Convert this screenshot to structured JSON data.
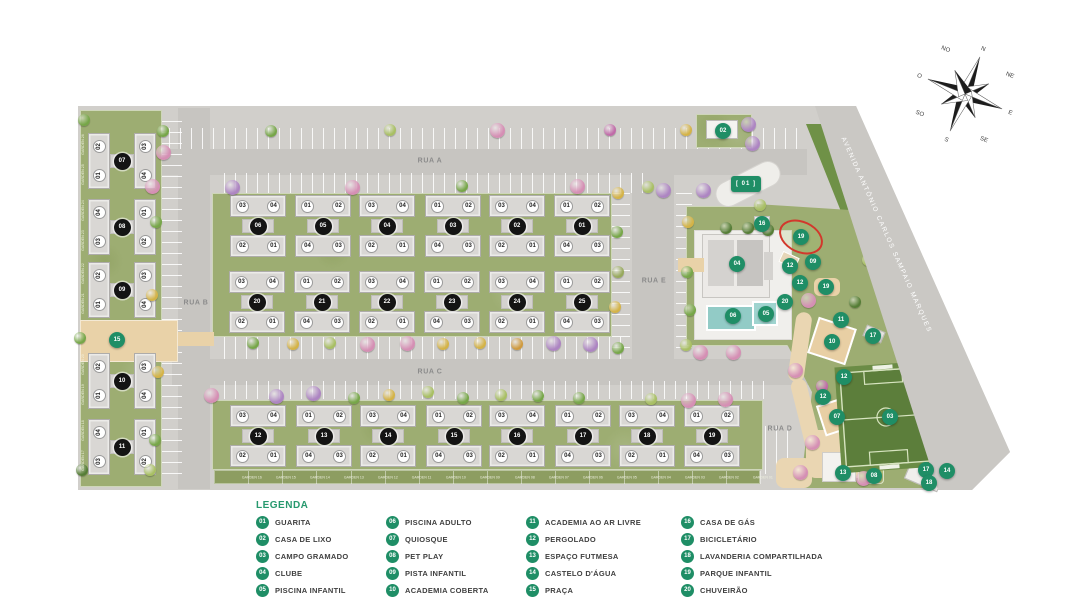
{
  "plan": {
    "avenue_label": "AVENIDA ANTÔNIO CARLOS SAMPAIO MARQUES",
    "streets": [
      {
        "label": "RUA A",
        "x": 430,
        "y": 161
      },
      {
        "label": "RUA B",
        "x": 196,
        "y": 303
      },
      {
        "label": "RUA C",
        "x": 430,
        "y": 372
      },
      {
        "label": "RUA D",
        "x": 780,
        "y": 429
      },
      {
        "label": "RUA E",
        "x": 654,
        "y": 281
      }
    ],
    "rows": [
      {
        "y": 226,
        "blocks": [
          {
            "id": "06",
            "x": 258,
            "top": [
              "03",
              "04"
            ],
            "bottom": [
              "02",
              "01"
            ]
          },
          {
            "id": "05",
            "x": 323,
            "top": [
              "01",
              "02"
            ],
            "bottom": [
              "04",
              "03"
            ]
          },
          {
            "id": "04",
            "x": 387,
            "top": [
              "03",
              "04"
            ],
            "bottom": [
              "02",
              "01"
            ]
          },
          {
            "id": "03",
            "x": 453,
            "top": [
              "01",
              "02"
            ],
            "bottom": [
              "04",
              "03"
            ]
          },
          {
            "id": "02",
            "x": 517,
            "top": [
              "03",
              "04"
            ],
            "bottom": [
              "02",
              "01"
            ]
          },
          {
            "id": "01",
            "x": 582,
            "top": [
              "01",
              "02"
            ],
            "bottom": [
              "04",
              "03"
            ]
          }
        ]
      },
      {
        "y": 302,
        "blocks": [
          {
            "id": "20",
            "x": 257,
            "top": [
              "03",
              "04"
            ],
            "bottom": [
              "02",
              "01"
            ]
          },
          {
            "id": "21",
            "x": 322,
            "top": [
              "01",
              "02"
            ],
            "bottom": [
              "04",
              "03"
            ]
          },
          {
            "id": "22",
            "x": 387,
            "top": [
              "03",
              "04"
            ],
            "bottom": [
              "02",
              "01"
            ]
          },
          {
            "id": "23",
            "x": 452,
            "top": [
              "01",
              "02"
            ],
            "bottom": [
              "04",
              "03"
            ]
          },
          {
            "id": "24",
            "x": 517,
            "top": [
              "03",
              "04"
            ],
            "bottom": [
              "02",
              "01"
            ]
          },
          {
            "id": "25",
            "x": 582,
            "top": [
              "01",
              "02"
            ],
            "bottom": [
              "04",
              "03"
            ]
          }
        ]
      },
      {
        "y": 436,
        "blocks": [
          {
            "id": "12",
            "x": 258,
            "top": [
              "03",
              "04"
            ],
            "bottom": [
              "02",
              "01"
            ]
          },
          {
            "id": "13",
            "x": 324,
            "top": [
              "01",
              "02"
            ],
            "bottom": [
              "04",
              "03"
            ]
          },
          {
            "id": "14",
            "x": 388,
            "top": [
              "03",
              "04"
            ],
            "bottom": [
              "02",
              "01"
            ]
          },
          {
            "id": "15",
            "x": 454,
            "top": [
              "01",
              "02"
            ],
            "bottom": [
              "04",
              "03"
            ]
          },
          {
            "id": "16",
            "x": 517,
            "top": [
              "03",
              "04"
            ],
            "bottom": [
              "02",
              "01"
            ]
          },
          {
            "id": "17",
            "x": 583,
            "top": [
              "01",
              "02"
            ],
            "bottom": [
              "04",
              "03"
            ]
          },
          {
            "id": "18",
            "x": 647,
            "top": [
              "03",
              "04"
            ],
            "bottom": [
              "02",
              "01"
            ]
          },
          {
            "id": "19",
            "x": 712,
            "top": [
              "01",
              "02"
            ],
            "bottom": [
              "04",
              "03"
            ]
          }
        ]
      }
    ],
    "column": {
      "x": 122,
      "blocks": [
        {
          "id": "07",
          "y": 161,
          "left": [
            "02",
            "01"
          ],
          "right": [
            "03",
            "04"
          ]
        },
        {
          "id": "08",
          "y": 227,
          "left": [
            "04",
            "03"
          ],
          "right": [
            "01",
            "02"
          ]
        },
        {
          "id": "09",
          "y": 290,
          "left": [
            "02",
            "01"
          ],
          "right": [
            "03",
            "04"
          ]
        },
        {
          "id": "10",
          "y": 381,
          "left": [
            "02",
            "01"
          ],
          "right": [
            "03",
            "04"
          ]
        },
        {
          "id": "11",
          "y": 447,
          "left": [
            "04",
            "03"
          ],
          "right": [
            "01",
            "02"
          ]
        }
      ]
    },
    "amenities": [
      {
        "n": "02",
        "x": 723,
        "y": 131
      },
      {
        "n": "01",
        "x": 746,
        "y": 184,
        "entrance": true
      },
      {
        "n": "16",
        "x": 762,
        "y": 224
      },
      {
        "n": "19",
        "x": 801,
        "y": 237
      },
      {
        "n": "09",
        "x": 813,
        "y": 262
      },
      {
        "n": "12",
        "x": 790,
        "y": 266
      },
      {
        "n": "12",
        "x": 800,
        "y": 283
      },
      {
        "n": "19",
        "x": 826,
        "y": 287
      },
      {
        "n": "20",
        "x": 785,
        "y": 302
      },
      {
        "n": "04",
        "x": 737,
        "y": 264
      },
      {
        "n": "06",
        "x": 733,
        "y": 316
      },
      {
        "n": "05",
        "x": 766,
        "y": 314
      },
      {
        "n": "11",
        "x": 841,
        "y": 320
      },
      {
        "n": "10",
        "x": 832,
        "y": 342
      },
      {
        "n": "17",
        "x": 873,
        "y": 336
      },
      {
        "n": "12",
        "x": 844,
        "y": 377
      },
      {
        "n": "12",
        "x": 823,
        "y": 397
      },
      {
        "n": "07",
        "x": 837,
        "y": 417
      },
      {
        "n": "03",
        "x": 890,
        "y": 417
      },
      {
        "n": "13",
        "x": 843,
        "y": 473
      },
      {
        "n": "08",
        "x": 874,
        "y": 476
      },
      {
        "n": "17",
        "x": 926,
        "y": 470
      },
      {
        "n": "14",
        "x": 947,
        "y": 471
      },
      {
        "n": "18",
        "x": 929,
        "y": 483
      },
      {
        "n": "15",
        "x": 117,
        "y": 340
      }
    ],
    "gardens_bottom": [
      "GARDEN 16",
      "GARDEN 15",
      "GARDEN 14",
      "GARDEN 13",
      "GARDEN 12",
      "GARDEN 11",
      "GARDEN 10",
      "GARDEN 09",
      "GARDEN 08",
      "GARDEN 07",
      "GARDEN 06",
      "GARDEN 05",
      "GARDEN 04",
      "GARDEN 03",
      "GARDEN 02",
      "GARDEN 01"
    ],
    "gardens_left": [
      "GARDEN 26",
      "GARDEN 25",
      "GARDEN 24",
      "GARDEN 23",
      "GARDEN 22",
      "GARDEN 21",
      "GARDEN 20",
      "GARDEN 19",
      "GARDEN 18",
      "GARDEN 17"
    ]
  },
  "compass": {
    "labels": [
      "N",
      "NE",
      "E",
      "SE",
      "S",
      "SO",
      "O",
      "NO"
    ]
  },
  "legend": {
    "title": "LEGENDA",
    "columns": [
      [
        {
          "num": "01",
          "label": "GUARITA"
        },
        {
          "num": "02",
          "label": "CASA DE LIXO"
        },
        {
          "num": "03",
          "label": "CAMPO GRAMADO"
        },
        {
          "num": "04",
          "label": "CLUBE"
        },
        {
          "num": "05",
          "label": "PISCINA INFANTIL"
        }
      ],
      [
        {
          "num": "06",
          "label": "PISCINA ADULTO"
        },
        {
          "num": "07",
          "label": "QUIOSQUE"
        },
        {
          "num": "08",
          "label": "PET PLAY"
        },
        {
          "num": "09",
          "label": "PISTA INFANTIL"
        },
        {
          "num": "10",
          "label": "ACADEMIA COBERTA"
        }
      ],
      [
        {
          "num": "11",
          "label": "ACADEMIA AO AR LIVRE"
        },
        {
          "num": "12",
          "label": "PERGOLADO"
        },
        {
          "num": "13",
          "label": "ESPAÇO FUTMESA"
        },
        {
          "num": "14",
          "label": "CASTELO D'ÁGUA"
        },
        {
          "num": "15",
          "label": "PRAÇA"
        }
      ],
      [
        {
          "num": "16",
          "label": "CASA DE GÁS"
        },
        {
          "num": "17",
          "label": "BICICLETÁRIO"
        },
        {
          "num": "18",
          "label": "LAVANDERIA COMPARTILHADA"
        },
        {
          "num": "19",
          "label": "PARQUE INFANTIL"
        },
        {
          "num": "20",
          "label": "CHUVEIRÃO"
        }
      ]
    ]
  },
  "colors": {
    "legend_green": "#1f8e66",
    "highlight_red": "#d2382c",
    "field_green": "#5c7e3b",
    "ground_gray": "#d1cfcb"
  }
}
